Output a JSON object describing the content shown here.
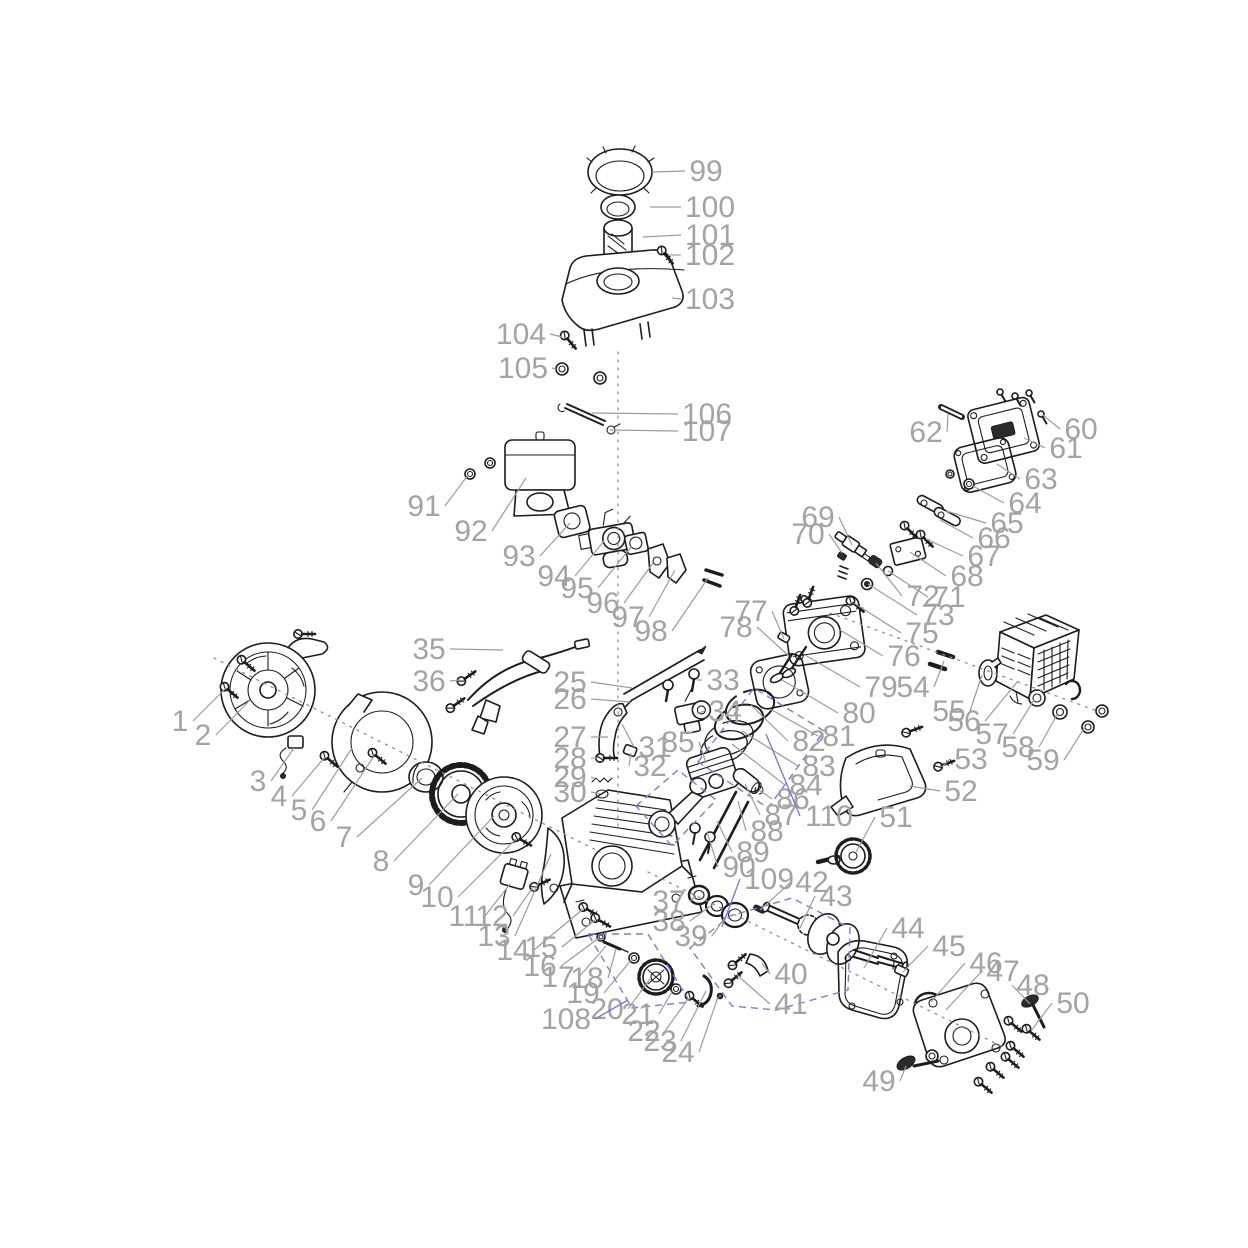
{
  "page": {
    "background": "#ffffff"
  },
  "colors": {
    "label": "#a3a3a3",
    "leader": "#9c9c9c",
    "part_stroke": "#1c1c1c",
    "callout_accent": "#7b7bd8",
    "axis": "#8f8f8f"
  },
  "diagram": {
    "type": "exploded-parts-diagram",
    "subject": "small gasoline engine parts breakdown",
    "labels": [
      {
        "n": "1",
        "x": 180,
        "y": 731,
        "tx": 226,
        "ty": 688
      },
      {
        "n": "2",
        "x": 203,
        "y": 745,
        "tx": 250,
        "ty": 700
      },
      {
        "n": "3",
        "x": 258,
        "y": 791,
        "tx": 294,
        "ty": 748
      },
      {
        "n": "4",
        "x": 279,
        "y": 806,
        "tx": 324,
        "ty": 758
      },
      {
        "n": "5",
        "x": 299,
        "y": 820,
        "tx": 352,
        "ty": 748
      },
      {
        "n": "6",
        "x": 318,
        "y": 831,
        "tx": 374,
        "ty": 756
      },
      {
        "n": "7",
        "x": 344,
        "y": 847,
        "tx": 422,
        "ty": 778
      },
      {
        "n": "8",
        "x": 381,
        "y": 871,
        "tx": 458,
        "ty": 794
      },
      {
        "n": "9",
        "x": 416,
        "y": 895,
        "tx": 494,
        "ty": 816
      },
      {
        "n": "10",
        "x": 437,
        "y": 907,
        "tx": 516,
        "ty": 839
      },
      {
        "n": "11",
        "x": 464,
        "y": 926,
        "tx": 510,
        "ty": 884
      },
      {
        "n": "12",
        "x": 492,
        "y": 926,
        "tx": 533,
        "ty": 887
      },
      {
        "n": "13",
        "x": 494,
        "y": 946,
        "tx": 551,
        "ty": 854
      },
      {
        "n": "14",
        "x": 513,
        "y": 960,
        "tx": 583,
        "ty": 909
      },
      {
        "n": "15",
        "x": 541,
        "y": 957,
        "tx": 595,
        "ty": 920
      },
      {
        "n": "16",
        "x": 540,
        "y": 976,
        "tx": 599,
        "ty": 938
      },
      {
        "n": "17",
        "x": 558,
        "y": 987,
        "tx": 606,
        "ty": 946
      },
      {
        "n": "18",
        "x": 587,
        "y": 988,
        "tx": 616,
        "ty": 949
      },
      {
        "n": "19",
        "x": 583,
        "y": 1003,
        "tx": 632,
        "ty": 959
      },
      {
        "n": "20",
        "x": 607,
        "y": 1019,
        "tx": 650,
        "ty": 979
      },
      {
        "n": "21",
        "x": 638,
        "y": 1024,
        "tx": 673,
        "ty": 990
      },
      {
        "n": "22",
        "x": 644,
        "y": 1041,
        "tx": 688,
        "ty": 999
      },
      {
        "n": "23",
        "x": 660,
        "y": 1051,
        "tx": 706,
        "ty": 991
      },
      {
        "n": "24",
        "x": 678,
        "y": 1062,
        "tx": 718,
        "ty": 997
      },
      {
        "n": "25",
        "x": 570,
        "y": 692,
        "tx": 632,
        "ty": 688
      },
      {
        "n": "26",
        "x": 570,
        "y": 709,
        "tx": 630,
        "ty": 702
      },
      {
        "n": "27",
        "x": 570,
        "y": 747,
        "tx": 608,
        "ty": 737
      },
      {
        "n": "28",
        "x": 570,
        "y": 768,
        "tx": 598,
        "ty": 758
      },
      {
        "n": "29",
        "x": 570,
        "y": 787,
        "tx": 598,
        "ty": 780
      },
      {
        "n": "30",
        "x": 570,
        "y": 802,
        "tx": 600,
        "ty": 794
      },
      {
        "n": "31",
        "x": 655,
        "y": 757,
        "tx": 622,
        "ty": 724
      },
      {
        "n": "32",
        "x": 650,
        "y": 776,
        "tx": 631,
        "ty": 753
      },
      {
        "n": "33",
        "x": 723,
        "y": 690,
        "tx": 697,
        "ty": 680
      },
      {
        "n": "34",
        "x": 725,
        "y": 721,
        "tx": 697,
        "ty": 714
      },
      {
        "n": "35",
        "x": 429,
        "y": 659,
        "tx": 503,
        "ty": 650
      },
      {
        "n": "36",
        "x": 429,
        "y": 691,
        "tx": 460,
        "ty": 680
      },
      {
        "n": "37",
        "x": 669,
        "y": 911,
        "tx": 696,
        "ty": 896
      },
      {
        "n": "38",
        "x": 669,
        "y": 931,
        "tx": 712,
        "ty": 905
      },
      {
        "n": "39",
        "x": 691,
        "y": 946,
        "tx": 728,
        "ty": 913
      },
      {
        "n": "40",
        "x": 791,
        "y": 984,
        "tx": 762,
        "ty": 963
      },
      {
        "n": "41",
        "x": 791,
        "y": 1014,
        "tx": 737,
        "ty": 975
      },
      {
        "n": "42",
        "x": 812,
        "y": 892,
        "tx": 760,
        "ty": 910
      },
      {
        "n": "43",
        "x": 836,
        "y": 906,
        "tx": 800,
        "ty": 928
      },
      {
        "n": "44",
        "x": 908,
        "y": 938,
        "tx": 864,
        "ty": 968
      },
      {
        "n": "45",
        "x": 949,
        "y": 956,
        "tx": 903,
        "ty": 972
      },
      {
        "n": "46",
        "x": 986,
        "y": 973,
        "tx": 931,
        "ty": 1002
      },
      {
        "n": "47",
        "x": 1003,
        "y": 981,
        "tx": 946,
        "ty": 1010
      },
      {
        "n": "48",
        "x": 1033,
        "y": 995,
        "tx": 1030,
        "ty": 1004
      },
      {
        "n": "49",
        "x": 879,
        "y": 1091,
        "tx": 906,
        "ty": 1066
      },
      {
        "n": "50",
        "x": 1073,
        "y": 1013,
        "tx": 1031,
        "ty": 1031
      },
      {
        "n": "51",
        "x": 896,
        "y": 827,
        "tx": 856,
        "ty": 852
      },
      {
        "n": "52",
        "x": 961,
        "y": 801,
        "tx": 910,
        "ty": 786
      },
      {
        "n": "53",
        "x": 971,
        "y": 769,
        "tx": 942,
        "ty": 767
      },
      {
        "n": "54",
        "x": 913,
        "y": 697,
        "tx": 944,
        "ty": 661
      },
      {
        "n": "55",
        "x": 949,
        "y": 721,
        "tx": 982,
        "ty": 675
      },
      {
        "n": "56",
        "x": 964,
        "y": 731,
        "tx": 1018,
        "ty": 681
      },
      {
        "n": "57",
        "x": 992,
        "y": 744,
        "tx": 1034,
        "ty": 700
      },
      {
        "n": "58",
        "x": 1018,
        "y": 757,
        "tx": 1058,
        "ty": 713
      },
      {
        "n": "59",
        "x": 1043,
        "y": 770,
        "tx": 1085,
        "ty": 727
      },
      {
        "n": "60",
        "x": 1081,
        "y": 439,
        "tx": 1043,
        "ty": 415
      },
      {
        "n": "61",
        "x": 1066,
        "y": 458,
        "tx": 1024,
        "ty": 438
      },
      {
        "n": "62",
        "x": 926,
        "y": 442,
        "tx": 948,
        "ty": 414
      },
      {
        "n": "63",
        "x": 1041,
        "y": 489,
        "tx": 997,
        "ty": 464
      },
      {
        "n": "64",
        "x": 1025,
        "y": 513,
        "tx": 971,
        "ty": 485
      },
      {
        "n": "65",
        "x": 1007,
        "y": 533,
        "tx": 946,
        "ty": 511
      },
      {
        "n": "66",
        "x": 994,
        "y": 548,
        "tx": 940,
        "ty": 520
      },
      {
        "n": "67",
        "x": 984,
        "y": 566,
        "tx": 926,
        "ty": 539
      },
      {
        "n": "68",
        "x": 967,
        "y": 586,
        "tx": 910,
        "ty": 552
      },
      {
        "n": "69",
        "x": 818,
        "y": 527,
        "tx": 852,
        "ty": 545
      },
      {
        "n": "70",
        "x": 808,
        "y": 544,
        "tx": 842,
        "ty": 553
      },
      {
        "n": "71",
        "x": 949,
        "y": 607,
        "tx": 888,
        "ty": 571
      },
      {
        "n": "72",
        "x": 923,
        "y": 606,
        "tx": 876,
        "ty": 563
      },
      {
        "n": "73",
        "x": 938,
        "y": 625,
        "tx": 868,
        "ty": 584
      },
      {
        "n": "75",
        "x": 922,
        "y": 643,
        "tx": 854,
        "ty": 603
      },
      {
        "n": "76",
        "x": 904,
        "y": 666,
        "tx": 840,
        "ty": 630
      },
      {
        "n": "77",
        "x": 751,
        "y": 621,
        "tx": 784,
        "ty": 639
      },
      {
        "n": "78",
        "x": 736,
        "y": 637,
        "tx": 789,
        "ty": 656
      },
      {
        "n": "79",
        "x": 881,
        "y": 697,
        "tx": 805,
        "ty": 655
      },
      {
        "n": "80",
        "x": 859,
        "y": 723,
        "tx": 782,
        "ty": 680
      },
      {
        "n": "81",
        "x": 839,
        "y": 746,
        "tx": 770,
        "ty": 709
      },
      {
        "n": "82",
        "x": 809,
        "y": 751,
        "tx": 751,
        "ty": 705
      },
      {
        "n": "83",
        "x": 819,
        "y": 776,
        "tx": 742,
        "ty": 731
      },
      {
        "n": "84",
        "x": 806,
        "y": 795,
        "tx": 732,
        "ty": 744
      },
      {
        "n": "85",
        "x": 678,
        "y": 752,
        "tx": 706,
        "ty": 763
      },
      {
        "n": "86",
        "x": 793,
        "y": 809,
        "tx": 759,
        "ty": 790
      },
      {
        "n": "87",
        "x": 781,
        "y": 825,
        "tx": 745,
        "ty": 784
      },
      {
        "n": "88",
        "x": 767,
        "y": 841,
        "tx": 738,
        "ty": 801
      },
      {
        "n": "89",
        "x": 753,
        "y": 862,
        "tx": 717,
        "ty": 821
      },
      {
        "n": "90",
        "x": 739,
        "y": 877,
        "tx": 707,
        "ty": 832
      },
      {
        "n": "91",
        "x": 424,
        "y": 516,
        "tx": 468,
        "ty": 475
      },
      {
        "n": "92",
        "x": 471,
        "y": 541,
        "tx": 526,
        "ty": 478
      },
      {
        "n": "93",
        "x": 519,
        "y": 566,
        "tx": 570,
        "ty": 523
      },
      {
        "n": "94",
        "x": 554,
        "y": 586,
        "tx": 604,
        "ty": 541
      },
      {
        "n": "95",
        "x": 577,
        "y": 598,
        "tx": 632,
        "ty": 546
      },
      {
        "n": "96",
        "x": 603,
        "y": 613,
        "tx": 653,
        "ty": 563
      },
      {
        "n": "97",
        "x": 628,
        "y": 627,
        "tx": 675,
        "ty": 570
      },
      {
        "n": "98",
        "x": 651,
        "y": 641,
        "tx": 708,
        "ty": 578
      },
      {
        "n": "99",
        "x": 706,
        "y": 181,
        "tx": 652,
        "ty": 172
      },
      {
        "n": "100",
        "x": 710,
        "y": 217,
        "tx": 650,
        "ty": 207
      },
      {
        "n": "101",
        "x": 710,
        "y": 245,
        "tx": 643,
        "ty": 237
      },
      {
        "n": "102",
        "x": 710,
        "y": 265,
        "tx": 668,
        "ty": 255
      },
      {
        "n": "103",
        "x": 710,
        "y": 309,
        "tx": 672,
        "ty": 298
      },
      {
        "n": "104",
        "x": 521,
        "y": 344,
        "tx": 562,
        "ty": 337
      },
      {
        "n": "105",
        "x": 523,
        "y": 378,
        "tx": 556,
        "ty": 369
      },
      {
        "n": "106",
        "x": 707,
        "y": 424,
        "tx": 592,
        "ty": 413
      },
      {
        "n": "107",
        "x": 707,
        "y": 441,
        "tx": 610,
        "ty": 430
      },
      {
        "n": "108",
        "x": 566,
        "y": 1029,
        "tx": 628,
        "ty": 1000,
        "c": "p"
      },
      {
        "n": "109",
        "x": 769,
        "y": 889,
        "tx": 722,
        "ty": 927,
        "c": "p"
      },
      {
        "n": "110",
        "x": 829,
        "y": 826,
        "tx": 766,
        "ty": 734,
        "c": "p"
      }
    ],
    "groups": [
      {
        "name": "piston-ring-set-group",
        "points": [
          [
            698,
            762
          ],
          [
            754,
            688
          ],
          [
            824,
            731
          ],
          [
            768,
            808
          ]
        ]
      },
      {
        "name": "connecting-rod-group",
        "points": [
          [
            636,
            806
          ],
          [
            678,
            770
          ],
          [
            716,
            800
          ],
          [
            672,
            846
          ]
        ]
      },
      {
        "name": "governor-gear-group",
        "points": [
          [
            588,
            934
          ],
          [
            648,
            934
          ],
          [
            690,
            1002
          ],
          [
            632,
            1008
          ]
        ]
      },
      {
        "name": "crankshaft-group",
        "points": [
          [
            690,
            948
          ],
          [
            730,
            916
          ],
          [
            792,
            898
          ],
          [
            850,
            928
          ],
          [
            848,
            990
          ],
          [
            776,
            1010
          ],
          [
            732,
            1006
          ]
        ]
      }
    ],
    "axes": [
      [
        618,
        352,
        618,
        828
      ],
      [
        214,
        658,
        600,
        852
      ],
      [
        648,
        872,
        1005,
        1048
      ],
      [
        830,
        613,
        1100,
        712
      ]
    ]
  }
}
